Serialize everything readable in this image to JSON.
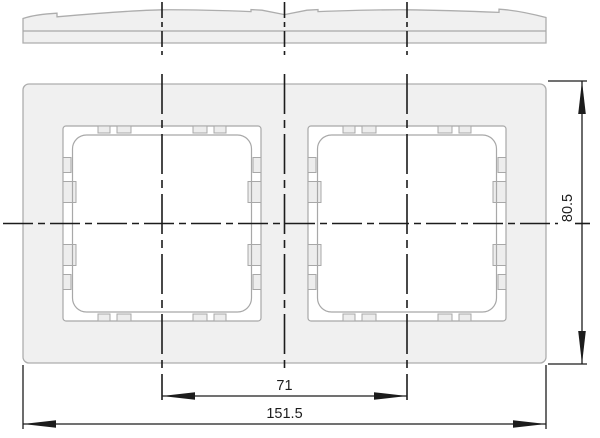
{
  "drawing": {
    "dimensions": {
      "overall_width_mm": "151.5",
      "center_spacing_mm": "71",
      "overall_height_mm": "80.5"
    },
    "colors": {
      "object_fill": "#f0f0f0",
      "object_outline": "#a8a8a8",
      "dimension_lines": "#1c1c1c"
    }
  }
}
